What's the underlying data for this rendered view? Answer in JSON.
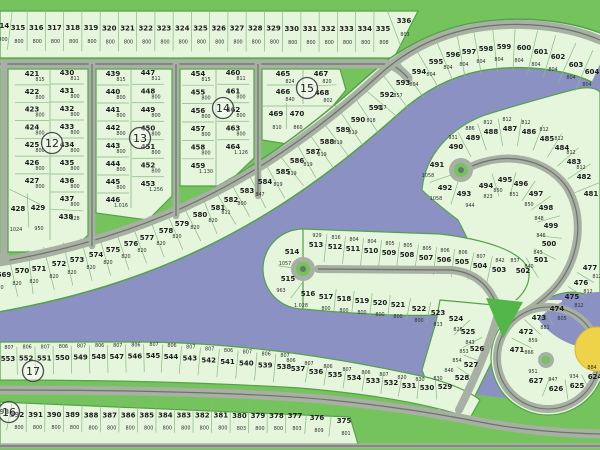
{
  "colors": {
    "water": "#8b92c3",
    "land": "#e5f6dd",
    "land_border": "#55a149",
    "green": "#74c35c",
    "road": "#a8afa3",
    "road_line": "#6b746a",
    "triangle_green": "#52b648",
    "yellow_feature": "#eed34a",
    "tick": "#8cb786"
  },
  "block_markers": [
    "12",
    "13",
    "14",
    "15",
    "16",
    "17"
  ],
  "groups": {
    "top_row": {
      "lots": [
        {
          "n": "314",
          "a": "800"
        },
        {
          "n": "315",
          "a": "800"
        },
        {
          "n": "316",
          "a": "800"
        },
        {
          "n": "317",
          "a": "800"
        },
        {
          "n": "318",
          "a": "800"
        },
        {
          "n": "319",
          "a": "800"
        },
        {
          "n": "320",
          "a": "800"
        },
        {
          "n": "321",
          "a": "800"
        },
        {
          "n": "322",
          "a": "800"
        },
        {
          "n": "323",
          "a": "800"
        },
        {
          "n": "324",
          "a": "800"
        },
        {
          "n": "325",
          "a": "800"
        },
        {
          "n": "326",
          "a": "800"
        },
        {
          "n": "327",
          "a": "800"
        },
        {
          "n": "328",
          "a": "800"
        },
        {
          "n": "329",
          "a": "800"
        },
        {
          "n": "330",
          "a": "800"
        },
        {
          "n": "331",
          "a": "800"
        },
        {
          "n": "332",
          "a": "800"
        },
        {
          "n": "333",
          "a": "800"
        },
        {
          "n": "334",
          "a": "800"
        },
        {
          "n": "335",
          "a": "808"
        },
        {
          "n": "336",
          "a": "803"
        }
      ]
    },
    "block12_left": {
      "lots": [
        {
          "n": "421",
          "a": "815"
        },
        {
          "n": "422",
          "a": "800"
        },
        {
          "n": "423",
          "a": "800"
        },
        {
          "n": "424",
          "a": "800"
        },
        {
          "n": "425",
          "a": "800"
        },
        {
          "n": "426",
          "a": "800"
        },
        {
          "n": "427",
          "a": "800"
        },
        {
          "n": "428",
          "a": "1024"
        },
        {
          "n": "429",
          "a": "950"
        }
      ]
    },
    "block12_right": {
      "lots": [
        {
          "n": "430",
          "a": "811"
        },
        {
          "n": "431",
          "a": "800"
        },
        {
          "n": "432",
          "a": "800"
        },
        {
          "n": "433",
          "a": "800"
        },
        {
          "n": "434",
          "a": "800"
        },
        {
          "n": "435",
          "a": "800"
        },
        {
          "n": "436",
          "a": "800"
        },
        {
          "n": "437",
          "a": "800"
        },
        {
          "n": "438",
          "a": "828"
        }
      ]
    },
    "block13_left": {
      "lots": [
        {
          "n": "439",
          "a": "815"
        },
        {
          "n": "440",
          "a": "800"
        },
        {
          "n": "441",
          "a": "800"
        },
        {
          "n": "442",
          "a": "800"
        },
        {
          "n": "443",
          "a": "800"
        },
        {
          "n": "444",
          "a": "800"
        },
        {
          "n": "445",
          "a": "800"
        },
        {
          "n": "446",
          "a": "1.016"
        }
      ]
    },
    "block13_right": {
      "lots": [
        {
          "n": "447",
          "a": "811"
        },
        {
          "n": "448",
          "a": "800"
        },
        {
          "n": "449",
          "a": "800"
        },
        {
          "n": "450",
          "a": "800"
        },
        {
          "n": "451",
          "a": "800"
        },
        {
          "n": "452",
          "a": "800"
        },
        {
          "n": "453",
          "a": "1.256"
        }
      ]
    },
    "block14_left": {
      "lots": [
        {
          "n": "454",
          "a": "815"
        },
        {
          "n": "455",
          "a": "800"
        },
        {
          "n": "456",
          "a": "800"
        },
        {
          "n": "457",
          "a": "800"
        },
        {
          "n": "458",
          "a": "800"
        },
        {
          "n": "459",
          "a": "1.130"
        }
      ]
    },
    "block14_right": {
      "lots": [
        {
          "n": "460",
          "a": "811"
        },
        {
          "n": "461",
          "a": "800"
        },
        {
          "n": "462",
          "a": "800"
        },
        {
          "n": "463",
          "a": "800"
        },
        {
          "n": "464",
          "a": "1.126"
        }
      ]
    },
    "block15_top_left": {
      "lots": [
        {
          "n": "465",
          "a": "824"
        },
        {
          "n": "466",
          "a": "840"
        }
      ]
    },
    "block15_top_right": {
      "lots": [
        {
          "n": "467",
          "a": "820"
        },
        {
          "n": "468",
          "a": "802"
        }
      ]
    },
    "block15_lower": {
      "lots": [
        {
          "n": "469",
          "a": "810"
        },
        {
          "n": "470",
          "a": "860"
        }
      ]
    },
    "fan_569_604": {
      "lots": [
        {
          "n": "569",
          "a": "820"
        },
        {
          "n": "570",
          "a": "820"
        },
        {
          "n": "571",
          "a": "820"
        },
        {
          "n": "572",
          "a": "820"
        },
        {
          "n": "573",
          "a": "820"
        },
        {
          "n": "574",
          "a": "820"
        },
        {
          "n": "575",
          "a": "820"
        },
        {
          "n": "576",
          "a": "820"
        },
        {
          "n": "577",
          "a": "820"
        },
        {
          "n": "578",
          "a": "820"
        },
        {
          "n": "579",
          "a": "820"
        },
        {
          "n": "580",
          "a": "820"
        },
        {
          "n": "581",
          "a": "820"
        },
        {
          "n": "582",
          "a": "811"
        },
        {
          "n": "583",
          "a": "800"
        },
        {
          "n": "584",
          "a": "847"
        },
        {
          "n": "585",
          "a": "819"
        },
        {
          "n": "586",
          "a": "819"
        },
        {
          "n": "587",
          "a": "819"
        },
        {
          "n": "588",
          "a": "819"
        },
        {
          "n": "589",
          "a": "819"
        },
        {
          "n": "590",
          "a": "819"
        },
        {
          "n": "591",
          "a": "818"
        },
        {
          "n": "592",
          "a": "817"
        },
        {
          "n": "593",
          "a": "857"
        },
        {
          "n": "594",
          "a": "804"
        },
        {
          "n": "595",
          "a": "804"
        },
        {
          "n": "596",
          "a": "804"
        },
        {
          "n": "597",
          "a": "804"
        },
        {
          "n": "598",
          "a": "804"
        },
        {
          "n": "599",
          "a": "804"
        },
        {
          "n": "600",
          "a": "804"
        },
        {
          "n": "601",
          "a": "804"
        },
        {
          "n": "602",
          "a": "804"
        },
        {
          "n": "603",
          "a": "804"
        },
        {
          "n": "604",
          "a": "804"
        }
      ]
    },
    "spiral_outer": {
      "lots": [
        {
          "n": "490",
          "a": "931"
        },
        {
          "n": "489",
          "a": "886"
        },
        {
          "n": "488",
          "a": "812"
        },
        {
          "n": "487",
          "a": "812"
        },
        {
          "n": "486",
          "a": "812"
        },
        {
          "n": "485",
          "a": "812"
        },
        {
          "n": "484",
          "a": "812"
        },
        {
          "n": "483",
          "a": "812"
        },
        {
          "n": "482",
          "a": "812"
        },
        {
          "n": "481",
          "a": ""
        }
      ]
    },
    "spiral_left": {
      "lots": [
        {
          "n": "491",
          "a": "1058"
        },
        {
          "n": "492",
          "a": "1058"
        },
        {
          "n": "493",
          "a": "944"
        }
      ]
    },
    "spiral_inner": {
      "lots": [
        {
          "n": "494",
          "a": "823"
        },
        {
          "n": "495",
          "a": "850"
        },
        {
          "n": "496",
          "a": "851"
        },
        {
          "n": "497",
          "a": "850"
        },
        {
          "n": "498",
          "a": "848"
        },
        {
          "n": "499",
          "a": "846"
        },
        {
          "n": "500",
          "a": "843"
        },
        {
          "n": "501",
          "a": "840"
        },
        {
          "n": "502",
          "a": "837"
        }
      ]
    },
    "lollipop_top": {
      "lots": [
        {
          "n": "503",
          "a": "842"
        },
        {
          "n": "504",
          "a": "807"
        },
        {
          "n": "505",
          "a": "806"
        },
        {
          "n": "506",
          "a": "806"
        },
        {
          "n": "507",
          "a": "805"
        },
        {
          "n": "508",
          "a": "805"
        },
        {
          "n": "509",
          "a": "805"
        },
        {
          "n": "510",
          "a": "804"
        },
        {
          "n": "511",
          "a": "804"
        },
        {
          "n": "512",
          "a": "816"
        },
        {
          "n": "513",
          "a": "929"
        }
      ]
    },
    "lollipop_left": {
      "lots": [
        {
          "n": "514",
          "a": "1057"
        },
        {
          "n": "515",
          "a": "963"
        },
        {
          "n": "516",
          "a": "1.028"
        }
      ]
    },
    "lollipop_bottom": {
      "lots": [
        {
          "n": "517",
          "a": "800"
        },
        {
          "n": "518",
          "a": "800"
        },
        {
          "n": "519",
          "a": "800"
        },
        {
          "n": "520",
          "a": "800"
        },
        {
          "n": "521",
          "a": "800"
        },
        {
          "n": "522",
          "a": "800"
        },
        {
          "n": "523",
          "a": "813"
        }
      ]
    },
    "hook_up": {
      "lots": [
        {
          "n": "524",
          "a": "826"
        },
        {
          "n": "525",
          "a": "843"
        },
        {
          "n": "526",
          "a": "853"
        },
        {
          "n": "527",
          "a": "854"
        },
        {
          "n": "528",
          "a": "846"
        }
      ]
    },
    "hook_down": {
      "lots": [
        {
          "n": "529",
          "a": "830"
        },
        {
          "n": "530",
          "a": "830"
        },
        {
          "n": "531",
          "a": "820"
        },
        {
          "n": "532",
          "a": "807"
        },
        {
          "n": "533",
          "a": "806"
        },
        {
          "n": "534",
          "a": "807"
        },
        {
          "n": "535",
          "a": "806"
        },
        {
          "n": "536",
          "a": "807"
        },
        {
          "n": "537",
          "a": "806"
        }
      ]
    },
    "row_553_538": {
      "lots": [
        {
          "n": "553",
          "a": "807"
        },
        {
          "n": "552",
          "a": "806"
        },
        {
          "n": "551",
          "a": "807"
        },
        {
          "n": "550",
          "a": "806"
        },
        {
          "n": "549",
          "a": "807"
        },
        {
          "n": "548",
          "a": "806"
        },
        {
          "n": "547",
          "a": "807"
        },
        {
          "n": "546",
          "a": "806"
        },
        {
          "n": "545",
          "a": "807"
        },
        {
          "n": "544",
          "a": "806"
        },
        {
          "n": "543",
          "a": "807"
        },
        {
          "n": "542",
          "a": "807"
        },
        {
          "n": "541",
          "a": "806"
        },
        {
          "n": "540",
          "a": "807"
        },
        {
          "n": "539",
          "a": "806"
        },
        {
          "n": "538",
          "a": "807"
        }
      ]
    },
    "row_393_375": {
      "lots": [
        {
          "n": "393",
          "a": ""
        },
        {
          "n": "392",
          "a": "800"
        },
        {
          "n": "391",
          "a": "800"
        },
        {
          "n": "390",
          "a": "800"
        },
        {
          "n": "389",
          "a": "800"
        },
        {
          "n": "388",
          "a": "800"
        },
        {
          "n": "387",
          "a": "800"
        },
        {
          "n": "386",
          "a": "800"
        },
        {
          "n": "385",
          "a": "800"
        },
        {
          "n": "384",
          "a": "800"
        },
        {
          "n": "383",
          "a": "800"
        },
        {
          "n": "382",
          "a": "800"
        },
        {
          "n": "381",
          "a": "800"
        },
        {
          "n": "380",
          "a": "803"
        },
        {
          "n": "379",
          "a": "800"
        },
        {
          "n": "378",
          "a": "800"
        },
        {
          "n": "377",
          "a": "803"
        },
        {
          "n": "376",
          "a": "809"
        },
        {
          "n": "375",
          "a": "801"
        }
      ]
    },
    "circle_left": {
      "lots": [
        {
          "n": "471",
          "a": "866"
        },
        {
          "n": "472",
          "a": "859"
        },
        {
          "n": "473",
          "a": "881"
        },
        {
          "n": "474",
          "a": "805"
        }
      ]
    },
    "right_arc": {
      "lots": [
        {
          "n": "475",
          "a": "812"
        },
        {
          "n": "476",
          "a": "812"
        },
        {
          "n": "477",
          "a": "812"
        }
      ]
    },
    "circle_bottom": {
      "lots": [
        {
          "n": "627",
          "a": "951"
        },
        {
          "n": "626",
          "a": "947"
        },
        {
          "n": "625",
          "a": "934"
        },
        {
          "n": "624",
          "a": "884"
        }
      ]
    }
  }
}
